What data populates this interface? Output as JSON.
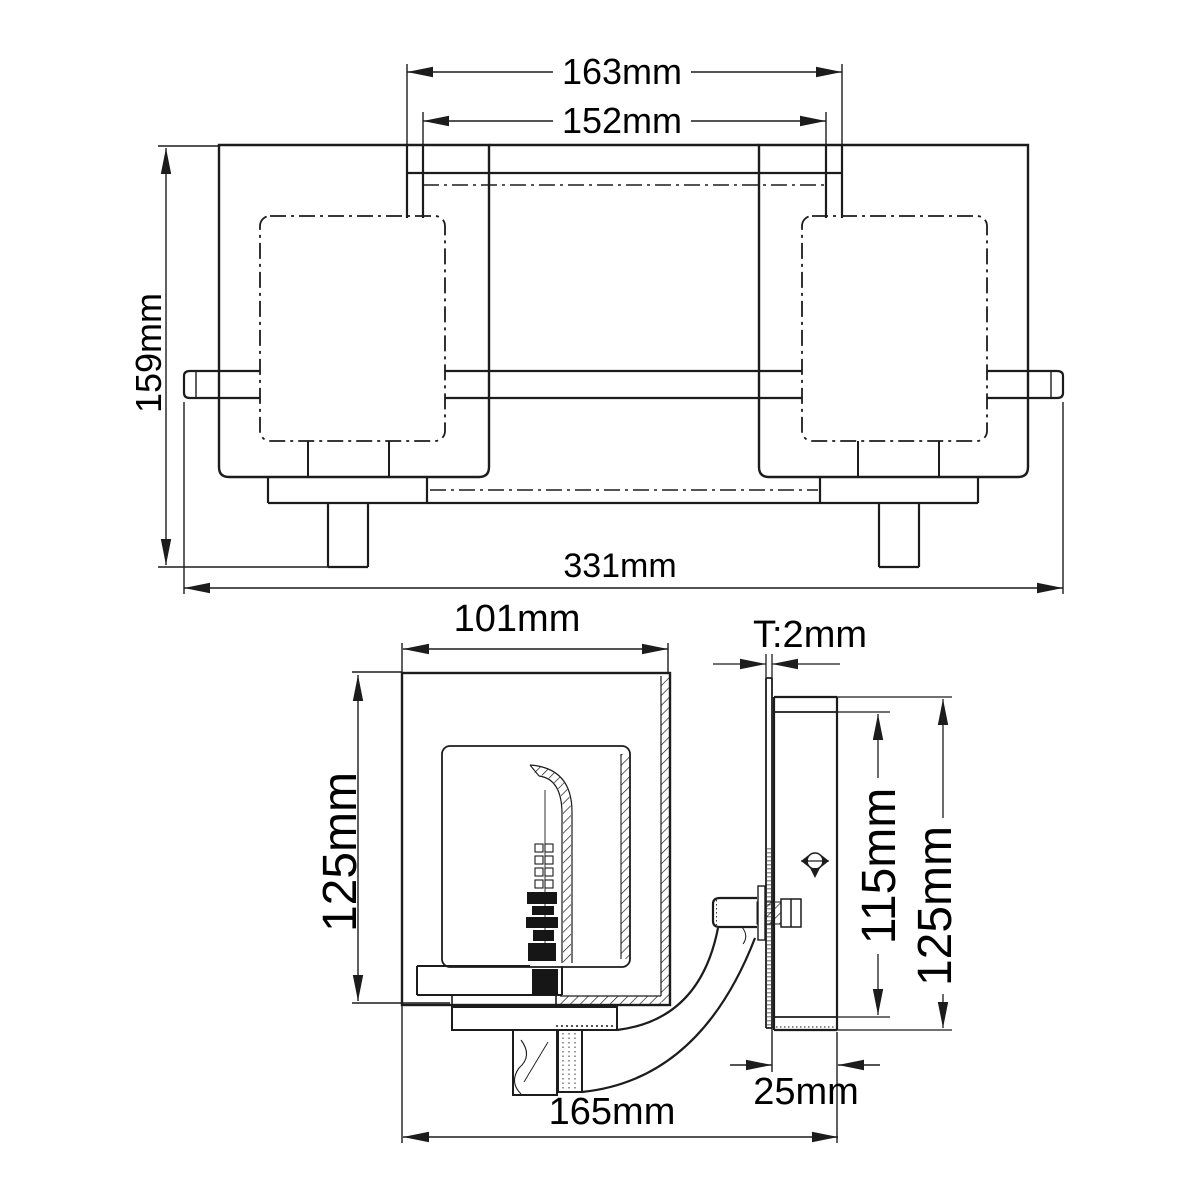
{
  "drawing": {
    "type": "technical-dimension-drawing",
    "subject": "two-light wall fixture with square glass shades",
    "front_view": {
      "dims": {
        "stem_spacing_outer": "163mm",
        "stem_spacing_inner": "152mm",
        "overall_height": "159mm",
        "overall_width": "331mm"
      }
    },
    "side_view": {
      "dims": {
        "shade_depth": "101mm",
        "shade_height": "125mm",
        "overall_projection": "165mm",
        "backplate_thickness": "T:2mm",
        "backplate_inner_height": "115mm",
        "backplate_height": "125mm",
        "backplate_depth": "25mm"
      }
    },
    "colors": {
      "line": "#1c1c1c",
      "text": "#000000",
      "background": "#ffffff"
    }
  }
}
